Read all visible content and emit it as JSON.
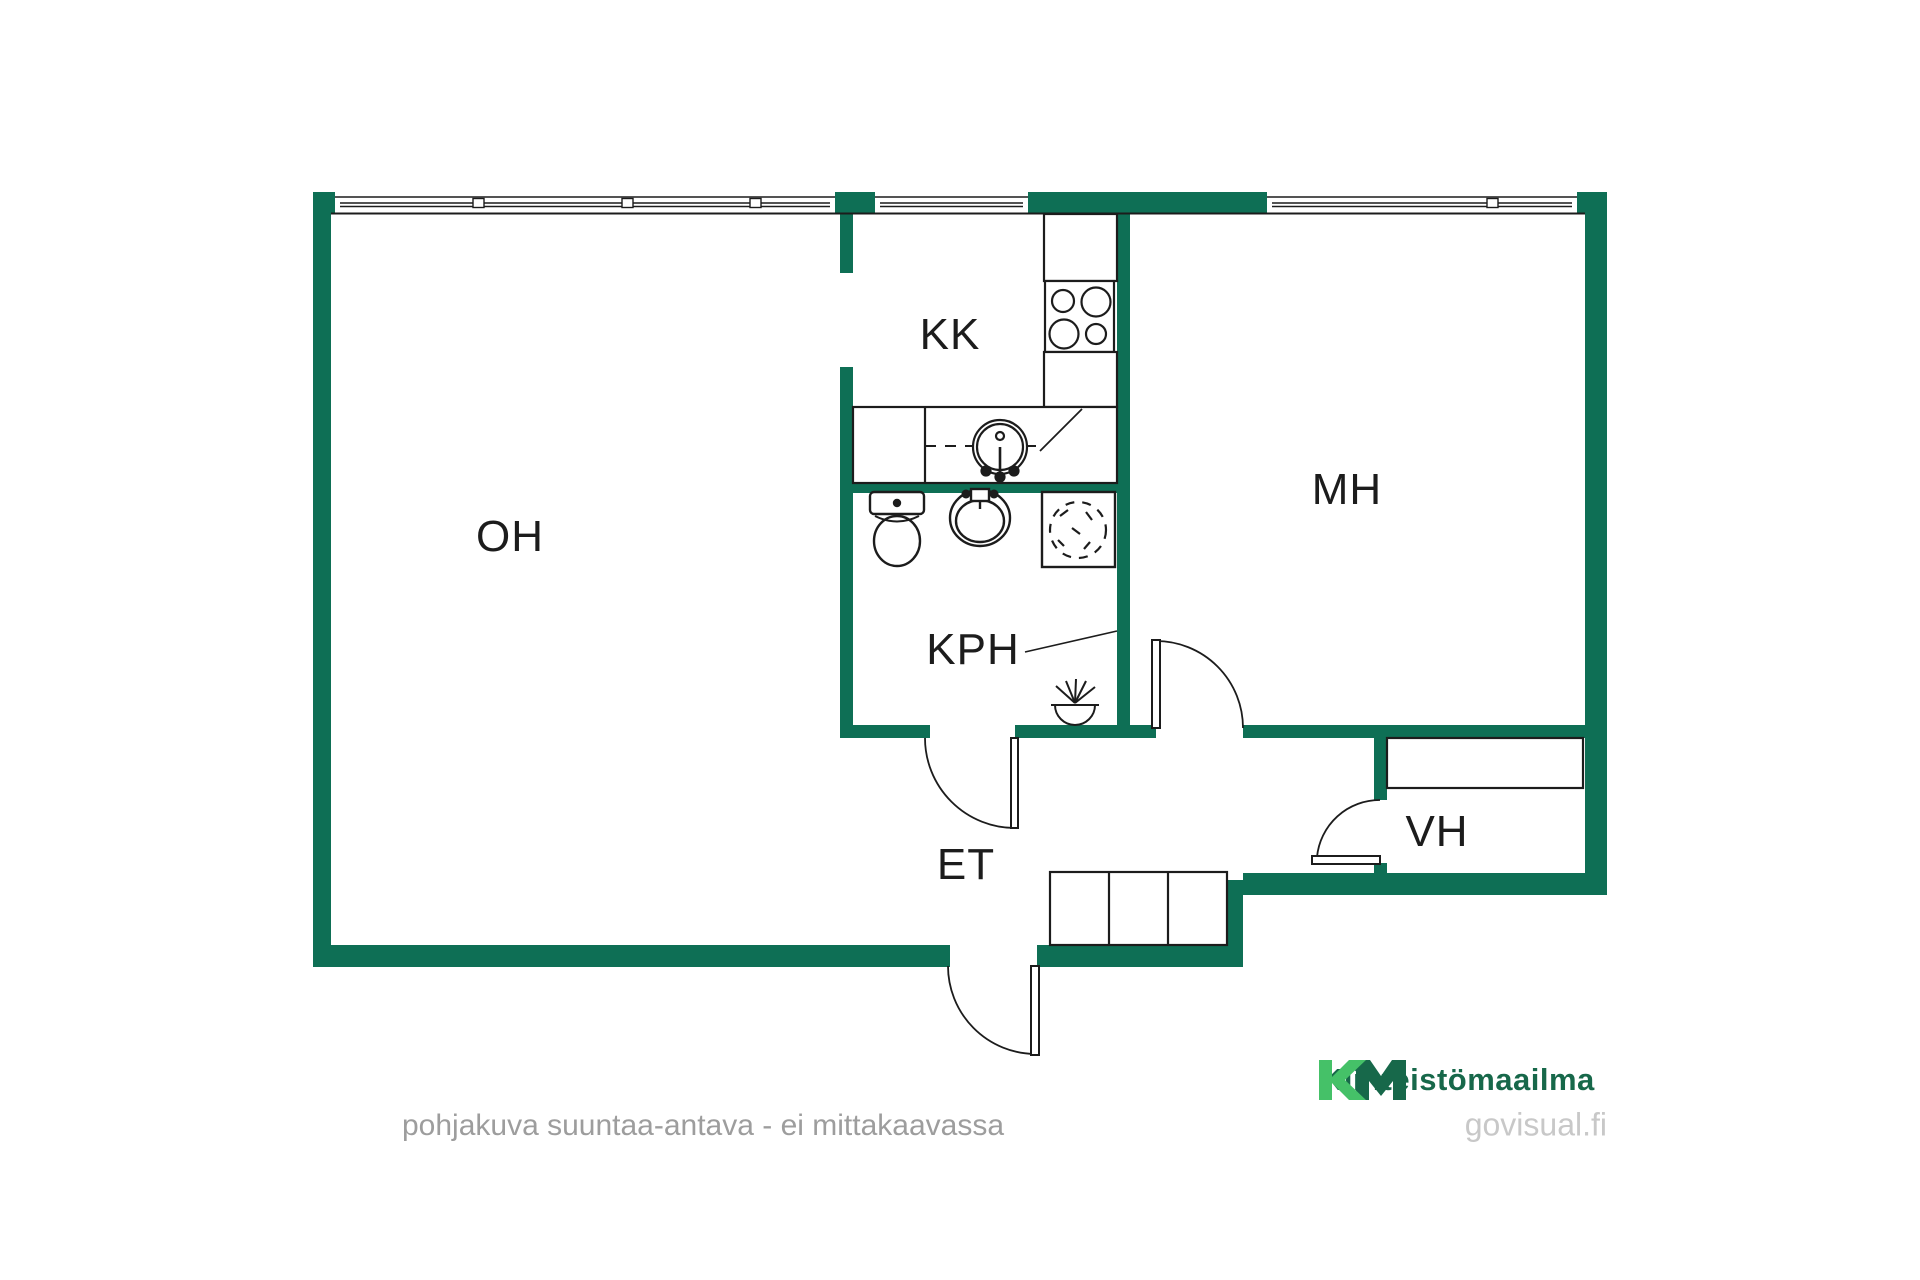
{
  "plan": {
    "rooms": [
      {
        "code": "OH"
      },
      {
        "code": "KK"
      },
      {
        "code": "MH"
      },
      {
        "code": "KPH"
      },
      {
        "code": "ET"
      },
      {
        "code": "VH"
      }
    ],
    "disclaimer": "pohjakuva suuntaa-antava - ei mittakaavassa"
  },
  "branding": {
    "logo_mark": "KM",
    "logo_text": "Kiinteistömaailma",
    "website": "govisual.fi"
  },
  "colors": {
    "wall": "#0e6f55",
    "line": "#1c1c1c",
    "logo_light_green": "#45c168",
    "logo_dark_green": "#17684a",
    "disclaimer_gray": "#9d9d9d",
    "website_gray": "#c8c8c8"
  }
}
